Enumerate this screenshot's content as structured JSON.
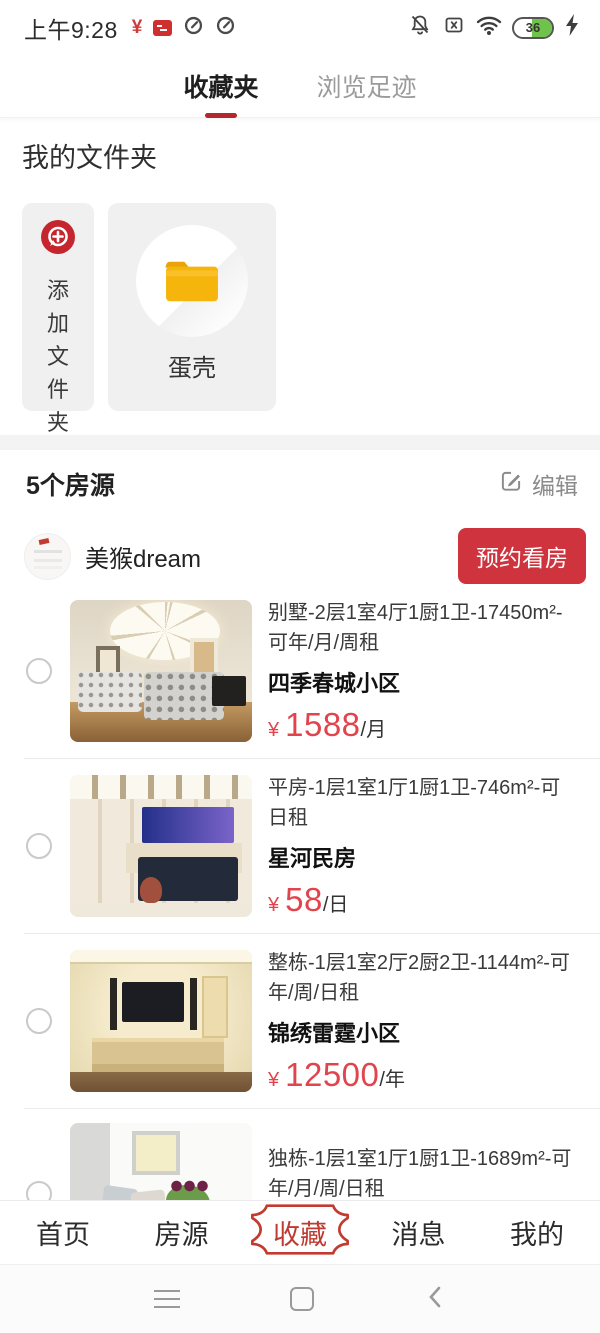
{
  "status_bar": {
    "time": "上午9:28",
    "yen": "¥",
    "battery": "36"
  },
  "tabs": {
    "favorites": "收藏夹",
    "history": "浏览足迹"
  },
  "folders": {
    "title": "我的文件夹",
    "add_label": "添加文件夹",
    "folder_name": "蛋壳"
  },
  "listings": {
    "count_label": "5个房源",
    "edit_label": "编辑",
    "owner_name": "美猴dream",
    "book_button": "预约看房",
    "items": [
      {
        "desc": "别墅-2层1室4厅1厨1卫-17450m²-可年/月/周租",
        "name": "四季春城小区",
        "currency": "¥",
        "price": "1588",
        "unit": "/月"
      },
      {
        "desc": "平房-1层1室1厅1厨1卫-746m²-可日租",
        "name": "星河民房",
        "currency": "¥",
        "price": "58",
        "unit": "/日"
      },
      {
        "desc": "整栋-1层1室2厅2厨2卫-1144m²-可年/周/日租",
        "name": "锦绣雷霆小区",
        "currency": "¥",
        "price": "12500",
        "unit": "/年"
      },
      {
        "desc": "独栋-1层1室1厅1厨1卫-1689m²-可年/月/周/日租",
        "name": "世纪春城花园"
      }
    ]
  },
  "bottom_nav": {
    "items": [
      {
        "label": "首页"
      },
      {
        "label": "房源"
      },
      {
        "label": "收藏"
      },
      {
        "label": "消息"
      },
      {
        "label": "我的"
      }
    ],
    "active": "收藏"
  },
  "colors": {
    "accent_red": "#c23b31",
    "button_red": "#ce333e",
    "price_red": "#e2444d",
    "folder_yellow": "#f6b50d"
  }
}
